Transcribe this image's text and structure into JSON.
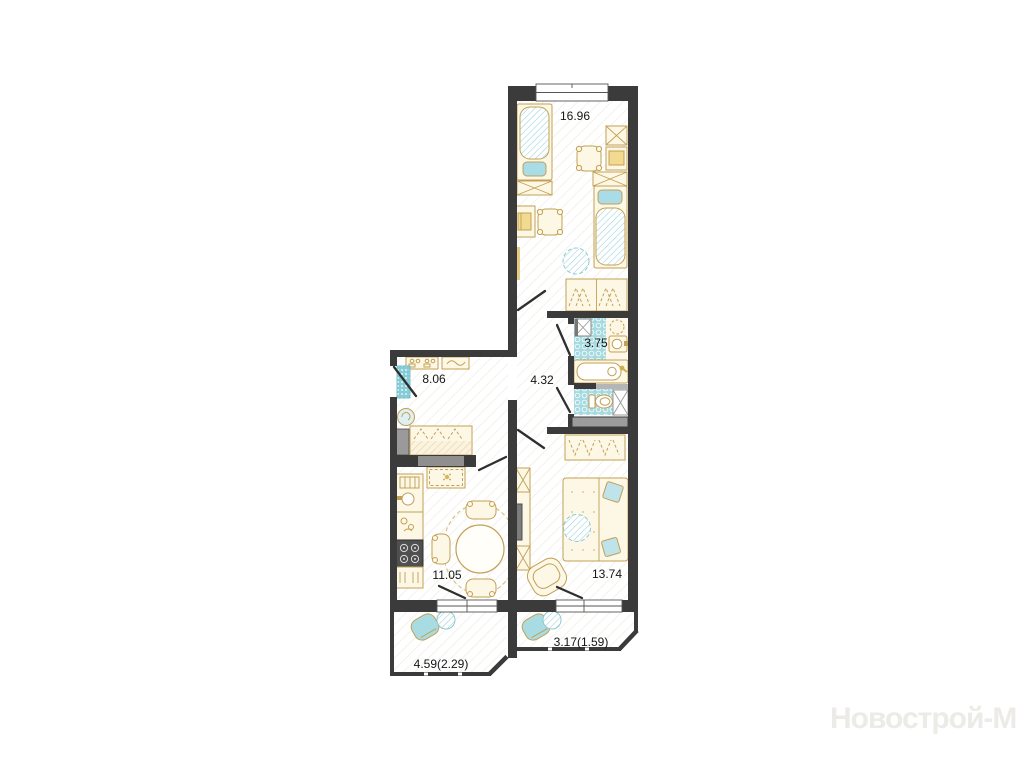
{
  "watermark": {
    "text": "Новострой-М"
  },
  "rooms": [
    {
      "id": "bedroom",
      "label": "16.96"
    },
    {
      "id": "entrance-hall",
      "label": "8.06"
    },
    {
      "id": "corridor",
      "label": "4.32"
    },
    {
      "id": "bathroom",
      "label": "3.75"
    },
    {
      "id": "kitchen",
      "label": "11.05"
    },
    {
      "id": "living-room",
      "label": "13.74"
    },
    {
      "id": "balcony-left",
      "label": "4.59(2.29)"
    },
    {
      "id": "balcony-right",
      "label": "3.17(1.59)"
    }
  ],
  "colors": {
    "wall": "#3b3b3b",
    "furniture_outline": "#c2a055",
    "furniture_fill": "#fdf7e5",
    "teal": "#8fd2da",
    "tile": "#a5dae0",
    "label_text": "#161616",
    "watermark_text": "#edebe8"
  }
}
